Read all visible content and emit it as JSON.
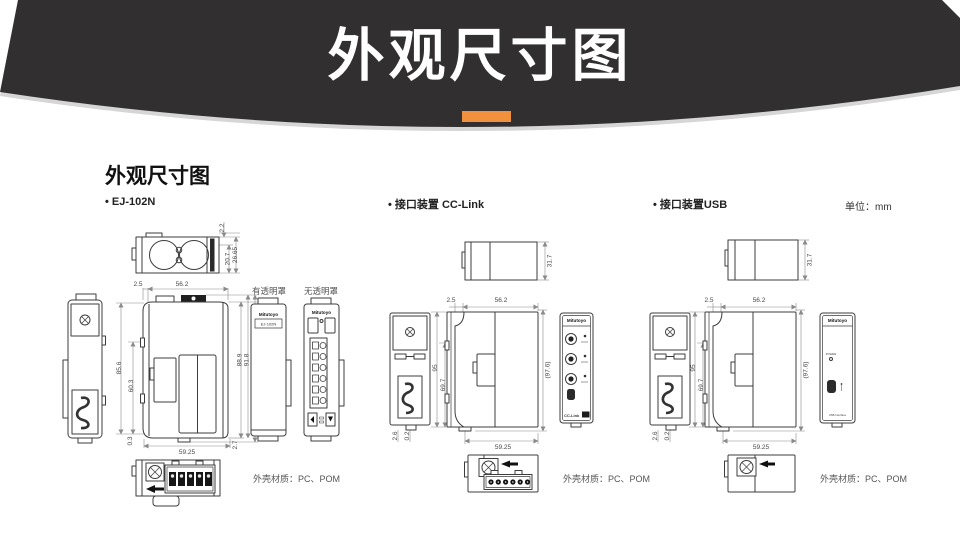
{
  "banner": {
    "title": "外观尺寸图",
    "bg_color": "#322F30",
    "accent_color": "#F2913D"
  },
  "content": {
    "section_title": "外观尺寸图",
    "unit_label": "单位：mm",
    "material_label": "外壳材质：PC、POM"
  },
  "ej102n": {
    "label": "• EJ-102N",
    "brand": "Mitutoyo",
    "model": "EJ-102N",
    "cover_with": "有透明罩",
    "cover_without": "无透明罩",
    "dims": {
      "top_a": "2.2",
      "top_b": "20.7",
      "top_c": "26.65",
      "front_offset": "2.5",
      "front_width": "56.2",
      "left_a": "85.6",
      "left_b": "60.3",
      "left_c": "0.3",
      "bottom_width": "59.25",
      "bottom_right": "2.7",
      "right_a": "88.9",
      "right_b": "91.8",
      "right_c": "(94.5)"
    }
  },
  "cclink": {
    "label": "• 接口装置 CC-Link",
    "brand": "Mitutoyo",
    "logo": "CC-Link",
    "dims": {
      "top": "31.7",
      "front_offset": "2.5",
      "front_width": "56.2",
      "left_a": "95",
      "left_b": "69.7",
      "right": "(97.6)",
      "bottom_a": "2.6",
      "bottom_b": "0.2",
      "bottom_width": "59.25"
    }
  },
  "usb": {
    "label": "• 接口装置USB",
    "brand": "Mitutoyo",
    "power_label": "POWER",
    "interface_label": "USB Interface",
    "dims": {
      "top": "31.7",
      "front_offset": "2.5",
      "front_width": "56.2",
      "left_a": "95",
      "left_b": "69.7",
      "right": "(97.6)",
      "bottom_a": "2.6",
      "bottom_b": "0.2",
      "bottom_width": "59.25"
    }
  }
}
